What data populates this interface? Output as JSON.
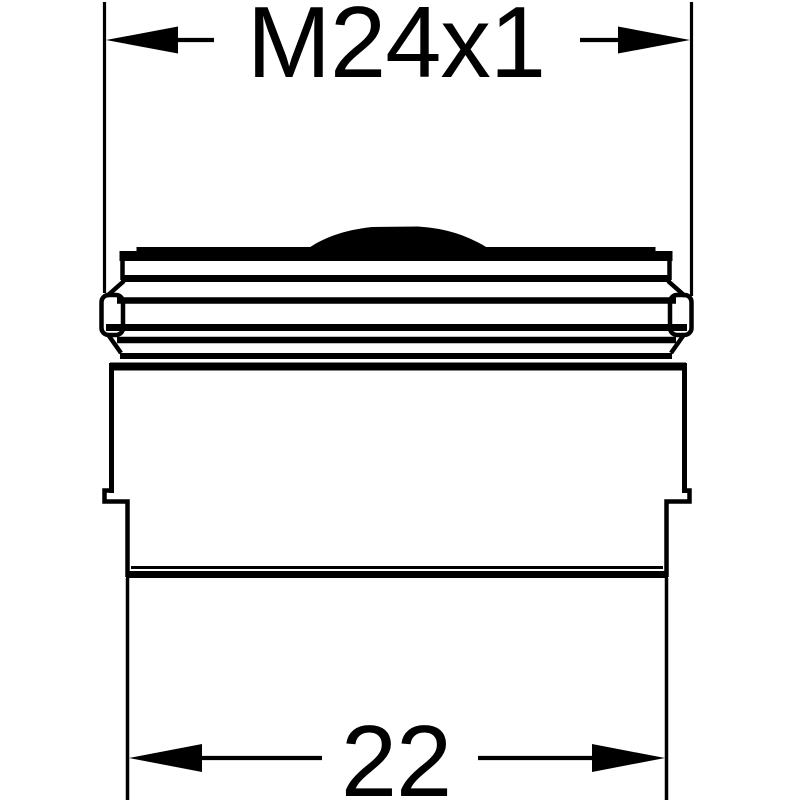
{
  "drawing": {
    "type": "technical-dimension-drawing",
    "subject": "aerator-side-profile",
    "colors": {
      "line": "#000000",
      "background": "#ffffff"
    },
    "dimensions": {
      "top": {
        "label": "M24x1"
      },
      "bottom": {
        "label": "22"
      }
    }
  }
}
